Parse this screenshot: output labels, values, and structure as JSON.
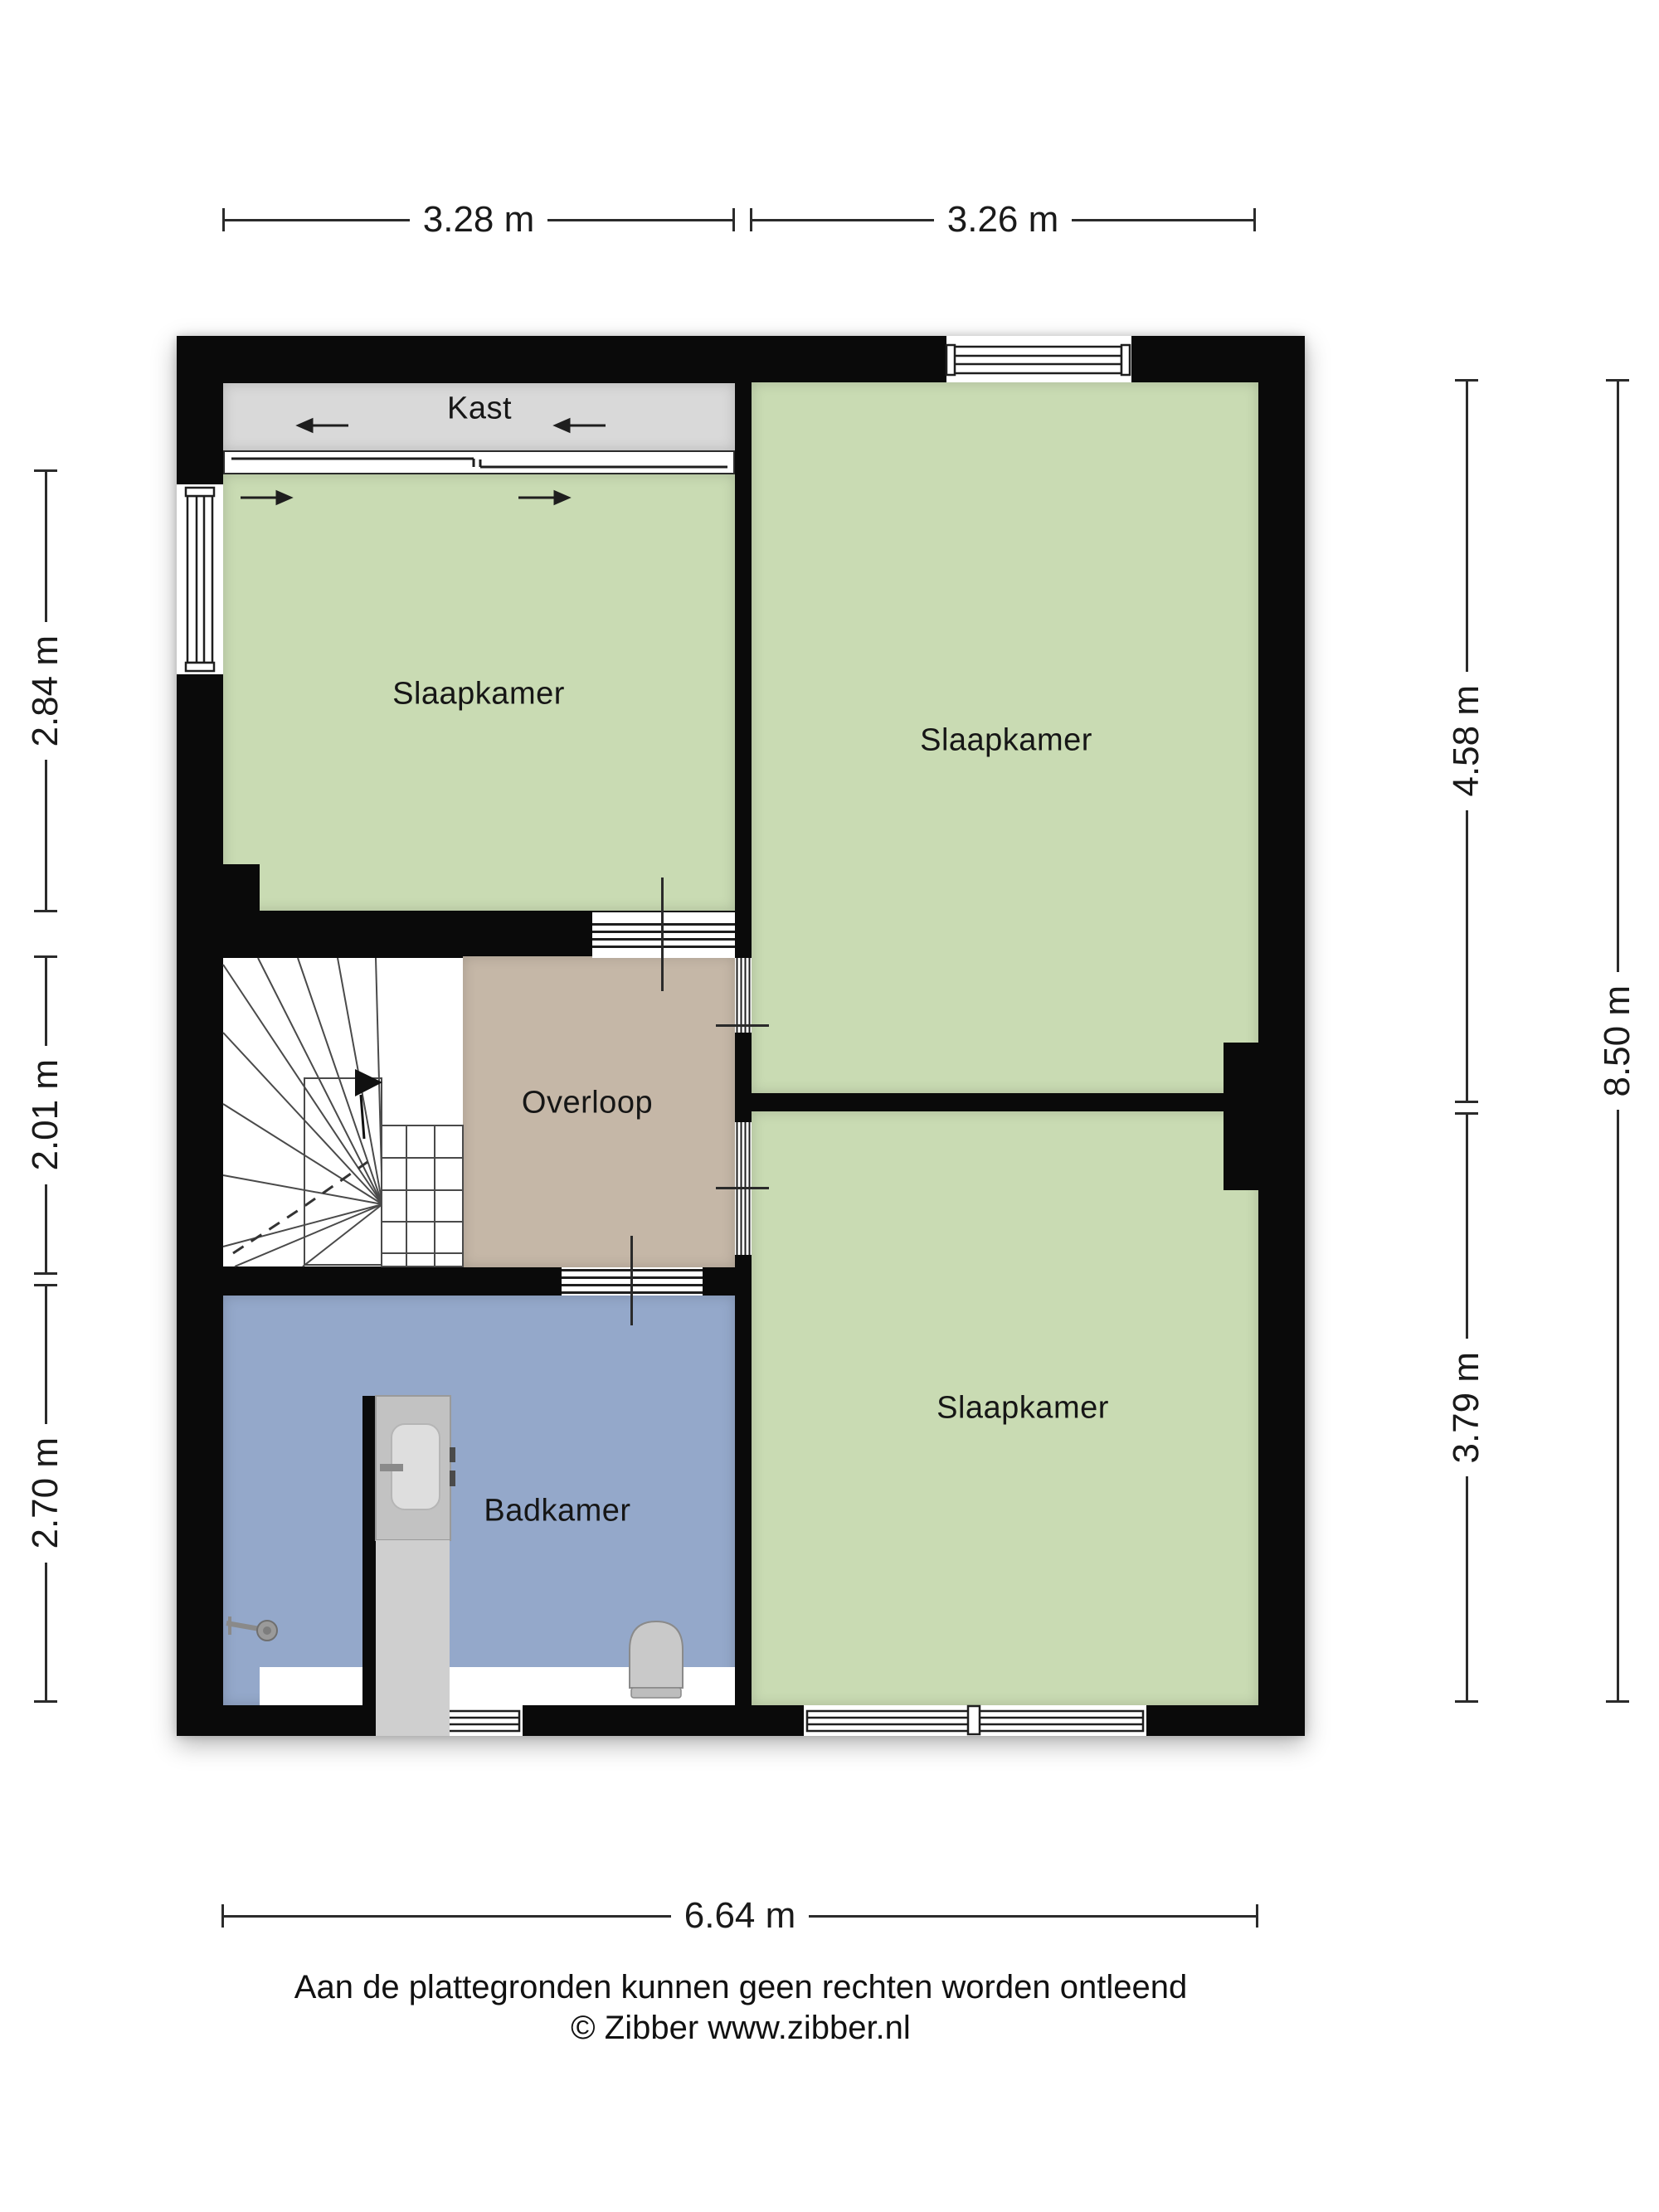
{
  "plan": {
    "rooms": {
      "kast": {
        "label": "Kast"
      },
      "slaapkamer_top_left": {
        "label": "Slaapkamer"
      },
      "slaapkamer_top_right": {
        "label": "Slaapkamer"
      },
      "overloop": {
        "label": "Overloop"
      },
      "badkamer": {
        "label": "Badkamer"
      },
      "slaapkamer_bottom_right": {
        "label": "Slaapkamer"
      }
    },
    "colors": {
      "wall": "#0a0a0a",
      "bedroom_green": "#c9dbb3",
      "landing_tan": "#c5b7a7",
      "bathroom_blue": "#94a8ca",
      "closet_gray": "#d9d9d9"
    }
  },
  "dimensions": {
    "top": [
      "3.28 m",
      "3.26 m"
    ],
    "left": [
      "2.84 m",
      "2.01 m",
      "2.70 m"
    ],
    "right_inner": [
      "4.58 m",
      "3.79 m"
    ],
    "right_outer": "8.50 m",
    "bottom": "6.64 m"
  },
  "footer": {
    "disclaimer": "Aan de plattegronden kunnen geen rechten worden ontleend",
    "credit": "© Zibber www.zibber.nl"
  }
}
